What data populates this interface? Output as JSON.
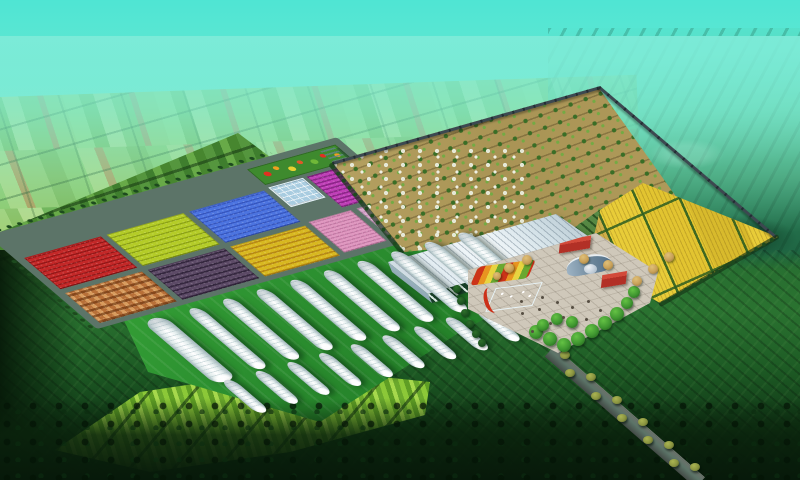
{
  "meta": {
    "title": "Aerial master-plan rendering of an agricultural demonstration park",
    "type": "3d-aerial-render",
    "width_px": 800,
    "height_px": 480
  },
  "palette": {
    "skyTop": "#4fe5d3",
    "groundDark": "#1d5a24",
    "forestDark": "#07190a",
    "lawnGreen": "#37a438",
    "roadGrey": "#5c7468",
    "plotRed": "#c42828",
    "plotLime": "#b4cc28",
    "plotBlue": "#4c74e0",
    "plotOrange": "#b87038",
    "plotPurple": "#5c4a66",
    "plotYellow": "#d8b820",
    "plotMagenta": "#c040b8",
    "plotPinkW": "#e098c0",
    "plotPinkE": "#d8a8cc",
    "glassBlue": "#a8cce0",
    "gardenGreen": "#3e8a2e",
    "orchardSoil": "#ab9655",
    "orchardTree": "#3a6e26",
    "goldTan": "#cfae48",
    "goldYellow": "#e8cc38",
    "cropGreen": "#3e7a28",
    "ghRoofLight": "#f4f9fb",
    "ghWallGreen": "#184028",
    "plazaPaving": "#cfc8ba",
    "poolBlue": "#28aed8",
    "brickRed": "#b23026",
    "slateRoof": "#6a8498",
    "wallDark": "#3c4850",
    "oliveTree": "#8a9440",
    "tunnelShade": "#9fb4b8"
  },
  "scene": {
    "sky": {
      "description": "hazy turquoise sky fading into a misty horizon",
      "top_color": "#4fe5d3"
    },
    "distant_farmland": {
      "description": "patchwork strips of green and tan fields with tree lines, dissolving into haze"
    },
    "distant_right": {
      "description": "darker rolling farmland and villages east of the walled park"
    },
    "site": {
      "crop_plots": [
        {
          "name": "red-crop-plot",
          "color": "#c42828"
        },
        {
          "name": "lime-green-crop-plot",
          "color": "#b4cc28"
        },
        {
          "name": "blue-crop-plot",
          "color": "#4c74e0"
        },
        {
          "name": "orange-checker-crop-plot",
          "color": "#b87038"
        },
        {
          "name": "dark-purple-crop-plot",
          "color": "#5c4a66"
        },
        {
          "name": "yellow-crop-plot",
          "color": "#d8b820"
        },
        {
          "name": "magenta-crop-plot",
          "color": "#c040b8"
        },
        {
          "name": "pink-crop-plot-west",
          "color": "#e098c0"
        },
        {
          "name": "pink-crop-plot-east",
          "color": "#d8a8cc"
        }
      ],
      "flower_garden": {
        "description": "ornamental parterre with red, orange, yellow and green beds beside a small white office building"
      },
      "glass_greenhouse": {
        "color": "#a8cce0"
      },
      "orchard": {
        "description": "grid of fruit trees on tan soil, white-blossom block at the west side",
        "soil_color": "#ab9655",
        "tree_color": "#3a6e26"
      },
      "grain_fields": {
        "description": "golden wheat cells separated by green strips inside the east wall",
        "colors": [
          "#e8cc38",
          "#cfae48",
          "#3e7a28"
        ]
      },
      "vegetable_plot": {
        "color": "#2e7024"
      },
      "main_greenhouse": {
        "description": "large gutter-connected glasshouse with white ribbed roof and arched dark-green glass wall"
      },
      "tunnel_greenhouses": {
        "total_count": 19,
        "large_tunnel": {
          "u": 34,
          "v": 112,
          "length": 97,
          "width": 23
        },
        "rows": [
          {
            "name": "back-row",
            "count": 9,
            "u0": 78,
            "v0": 113,
            "pitch": 35,
            "length": 93,
            "width": 15
          },
          {
            "name": "front-row",
            "count": 9,
            "u0": 40,
            "v0": 207,
            "pitch": 33,
            "length": 50,
            "width": 13
          }
        ]
      },
      "plaza": {
        "paving_color": "#cfc8ba",
        "pool_color": "#28aed8",
        "features": [
          "swimming-pool-with-fountains",
          "red-flower-arc",
          "flower-parterre",
          "red-brick-buildings",
          "curved-roof-exhibition-hall",
          "dome",
          "tree-groves",
          "visitors"
        ],
        "trees": [
          [
            536,
            332,
            7,
            "g"
          ],
          [
            550,
            339,
            7,
            "g"
          ],
          [
            564,
            345,
            7,
            "g"
          ],
          [
            578,
            339,
            7,
            "g"
          ],
          [
            592,
            331,
            7,
            "g"
          ],
          [
            605,
            323,
            7,
            "g"
          ],
          [
            617,
            314,
            7,
            "g"
          ],
          [
            627,
            303,
            6,
            "g"
          ],
          [
            634,
            292,
            6,
            "g"
          ],
          [
            572,
            322,
            6,
            "g"
          ],
          [
            557,
            319,
            6,
            "g"
          ],
          [
            543,
            325,
            6,
            "g"
          ],
          [
            457,
            289,
            4,
            "c"
          ],
          [
            461,
            301,
            4,
            "c"
          ],
          [
            465,
            313,
            4,
            "c"
          ],
          [
            470,
            324,
            4,
            "c"
          ],
          [
            476,
            334,
            4,
            "c"
          ],
          [
            482,
            343,
            4,
            "c"
          ],
          [
            509,
            268,
            5,
            "t"
          ],
          [
            527,
            260,
            5,
            "t"
          ],
          [
            584,
            259,
            5,
            "t"
          ],
          [
            608,
            265,
            5,
            "t"
          ],
          [
            637,
            281,
            5,
            "t"
          ],
          [
            653,
            269,
            5,
            "t"
          ],
          [
            669,
            257,
            5,
            "t"
          ],
          [
            497,
            276,
            4,
            "t"
          ]
        ],
        "visitor_dots": [
          [
            520,
            300
          ],
          [
            538,
            308
          ],
          [
            556,
            301
          ],
          [
            541,
            296
          ],
          [
            571,
            306
          ],
          [
            587,
            300
          ],
          [
            549,
            322
          ],
          [
            562,
            316
          ],
          [
            521,
            312
          ],
          [
            599,
            309
          ],
          [
            531,
            330
          ],
          [
            585,
            318
          ]
        ]
      },
      "boundary_wall": {
        "color": "#3c4850"
      },
      "access_road": {
        "description": "tree-lined road leaving the plaza toward the south-east",
        "tree_count": 12,
        "start": [
          562,
          358
        ],
        "step": [
          13,
          11.2
        ],
        "tree_color": "#8a9440"
      }
    },
    "surroundings": {
      "bright_plots_southwest": {
        "description": "striped bright-green vegetable plots separated by dark tree rows"
      },
      "forest_edge": {
        "description": "dark tree belt along the bottom of the view"
      },
      "fields_south": {
        "description": "large dark-green furrowed fields around the park"
      }
    }
  }
}
